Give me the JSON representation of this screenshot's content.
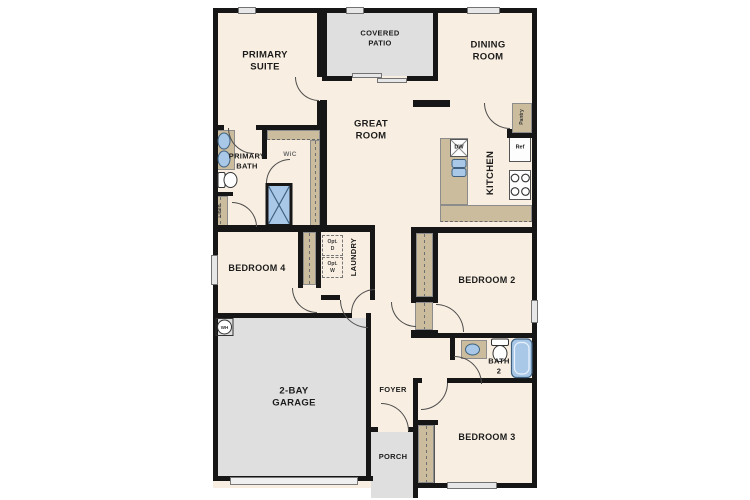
{
  "rooms": {
    "primary_suite": "PRIMARY\nSUITE",
    "covered_patio": "COVERED\nPATIO",
    "dining_room": "DINING\nROOM",
    "great_room": "GREAT\nROOM",
    "kitchen": "KITCHEN",
    "pantry": "Pantry",
    "primary_bath": "PRIMARY\nBATH",
    "wic": "WiC",
    "linen": "Linen",
    "bedroom_4": "BEDROOM 4",
    "laundry": "LAUNDRY",
    "opt_dryer": "Opt.\nD",
    "opt_washer": "Opt.\nW",
    "bedroom_2": "BEDROOM 2",
    "bath_2": "BATH\n2",
    "garage": "2-BAY\nGARAGE",
    "foyer": "FOYER",
    "porch": "PORCH",
    "bedroom_3": "BEDROOM 3"
  },
  "appliances": {
    "dishwasher": "DW",
    "refrigerator": "Ref",
    "water_heater": "WH"
  },
  "colors": {
    "floor": "#f8eee1",
    "outdoor": "#dfdfdf",
    "wall": "#161616",
    "casework": "#cbbc9d",
    "fixture_fill": "#a9c8e8",
    "fixture_stroke": "#3f617f"
  }
}
